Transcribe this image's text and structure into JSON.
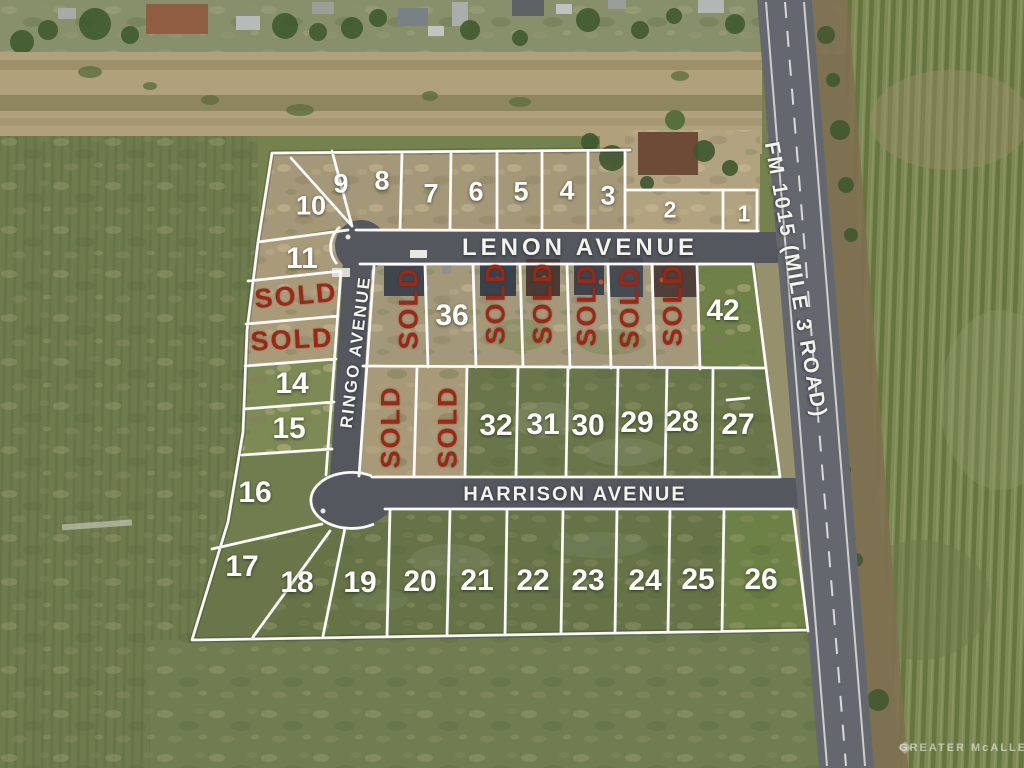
{
  "streets": {
    "lenon": "LENON AVENUE",
    "ringo": "RINGO AVENUE",
    "harrison": "HARRISON AVENUE",
    "fm1015": "FM 1015 (MILE 3 ROAD)"
  },
  "sold_text": "SOLD",
  "watermark": "GREATER McALLEN",
  "lots": {
    "l1": "1",
    "l2": "2",
    "l3": "3",
    "l4": "4",
    "l5": "5",
    "l6": "6",
    "l7": "7",
    "l8": "8",
    "l9": "9",
    "l10": "10",
    "l11": "11",
    "l14": "14",
    "l15": "15",
    "l16": "16",
    "l17": "17",
    "l18": "18",
    "l19": "19",
    "l20": "20",
    "l21": "21",
    "l22": "22",
    "l23": "23",
    "l24": "24",
    "l25": "25",
    "l26": "26",
    "l27": "27",
    "l28": "28",
    "l29": "29",
    "l30": "30",
    "l31": "31",
    "l32": "32",
    "l36": "36",
    "l42": "42"
  },
  "colors": {
    "sold_red": "#9b2817",
    "plat_line": "#ffffff",
    "road_gray": "#54585e",
    "highway_gray": "#64676d",
    "field_green": "#6d7b4d",
    "dirt_tan": "#a89a78"
  }
}
